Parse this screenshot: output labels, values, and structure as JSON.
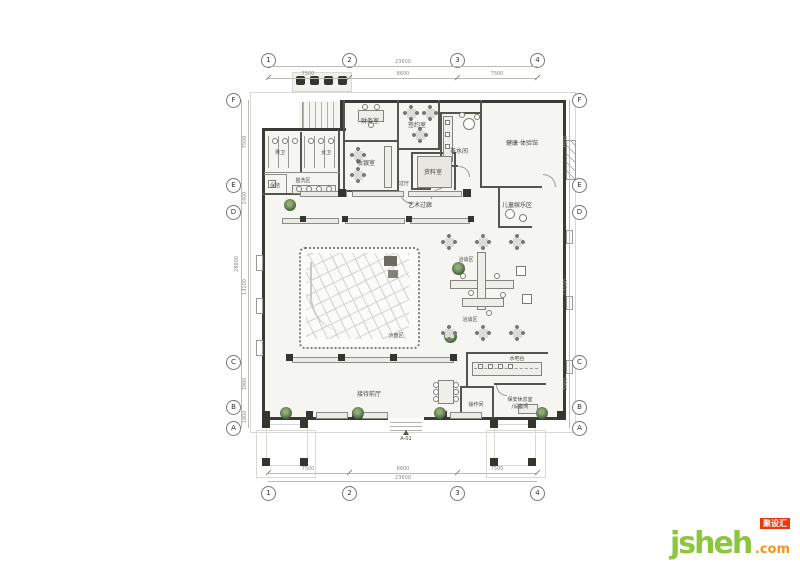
{
  "title": "clubhouse-floor-plan",
  "axes": {
    "top": [
      "1",
      "2",
      "3",
      "4"
    ],
    "bottom": [
      "1",
      "2",
      "3",
      "4"
    ],
    "left": [
      "F",
      "E",
      "D",
      "C",
      "B",
      "A"
    ],
    "right": [
      "F",
      "E",
      "D",
      "C",
      "B",
      "A"
    ]
  },
  "dimensions": {
    "top_overall": "23600",
    "top_segments": [
      "7500",
      "8600",
      "7500"
    ],
    "bottom_overall": "23600",
    "bottom_segments": [
      "7500",
      "8600",
      "7500"
    ],
    "left_overall": "28800",
    "left_segments": [
      "7500",
      "2400",
      "13200",
      "3900",
      "1800"
    ],
    "right_overall": "28800",
    "right_segments": [
      "7500",
      "2400",
      "13200",
      "3900",
      "1800"
    ]
  },
  "rooms": {
    "finance": "财务室",
    "cashier": "收银室",
    "signing": "签约室",
    "pantry": "茶水间",
    "health": "健康·体验馆",
    "archive": "资料室",
    "hallway": "过厅",
    "mens_wc": "男卫",
    "womens_wc": "女卫",
    "washing_area": "盥洗区",
    "cleaning": "保洁",
    "art_corridor": "艺术过廊",
    "kids_area": "儿童娱乐区",
    "sand_table": "沙盘区",
    "talk_area_upper": "洽谈区",
    "talk_area_lower": "洽谈区",
    "water_bar": "水吧台",
    "reception_hall": "接待前厅",
    "operation_room": "操作间",
    "security_room_line1": "保安休息室",
    "security_room_line2": "/设备间"
  },
  "markers": {
    "elevation": "A-01"
  },
  "watermark": {
    "name": "jsheh",
    "tld": ".com",
    "badge": "聚设汇"
  },
  "colors": {
    "wall": "#3b3b36",
    "plant_green": "#42593c",
    "logo_green": "#8CC63E",
    "logo_orange": "#F7941E",
    "badge_red": "#E8380D"
  }
}
